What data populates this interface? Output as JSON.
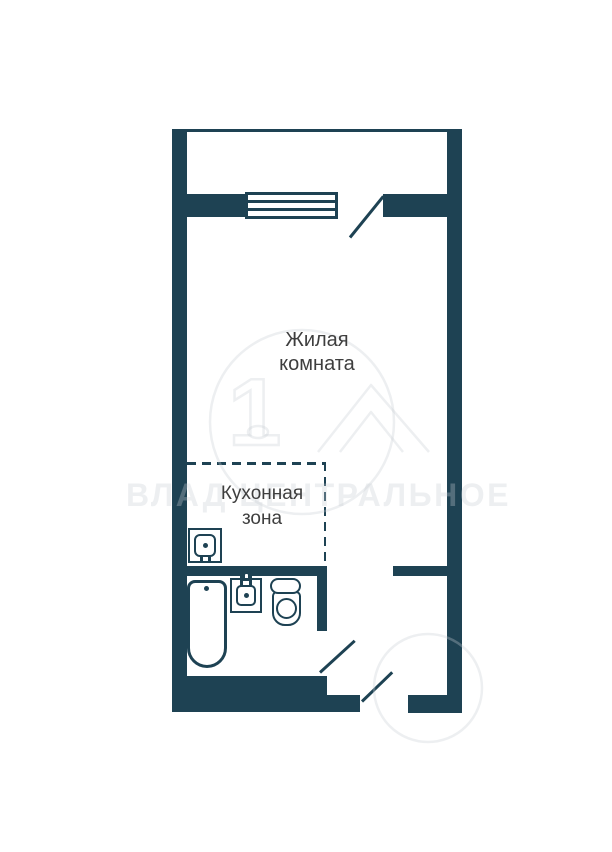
{
  "plan": {
    "living_room": {
      "line1": "Жилая",
      "line2": "комната"
    },
    "kitchen_zone": {
      "line1": "Кухонная",
      "line2": "зона"
    },
    "fixtures": {
      "kitchen_sink": "kitchen-sink",
      "bathtub": "bathtub",
      "washbasin": "washbasin",
      "toilet": "toilet"
    },
    "openings": {
      "balcony_window": "window",
      "balcony_door": "door-swing",
      "bathroom_door": "door-swing",
      "entry_door": "door-swing"
    },
    "colors": {
      "wall": "#1e4253",
      "label": "#3e3e3e"
    }
  },
  "watermark": {
    "text": "ВЛАД ЦЕНТРАЛЬНОЕ",
    "color": "rgba(200,205,210,0.32)"
  }
}
